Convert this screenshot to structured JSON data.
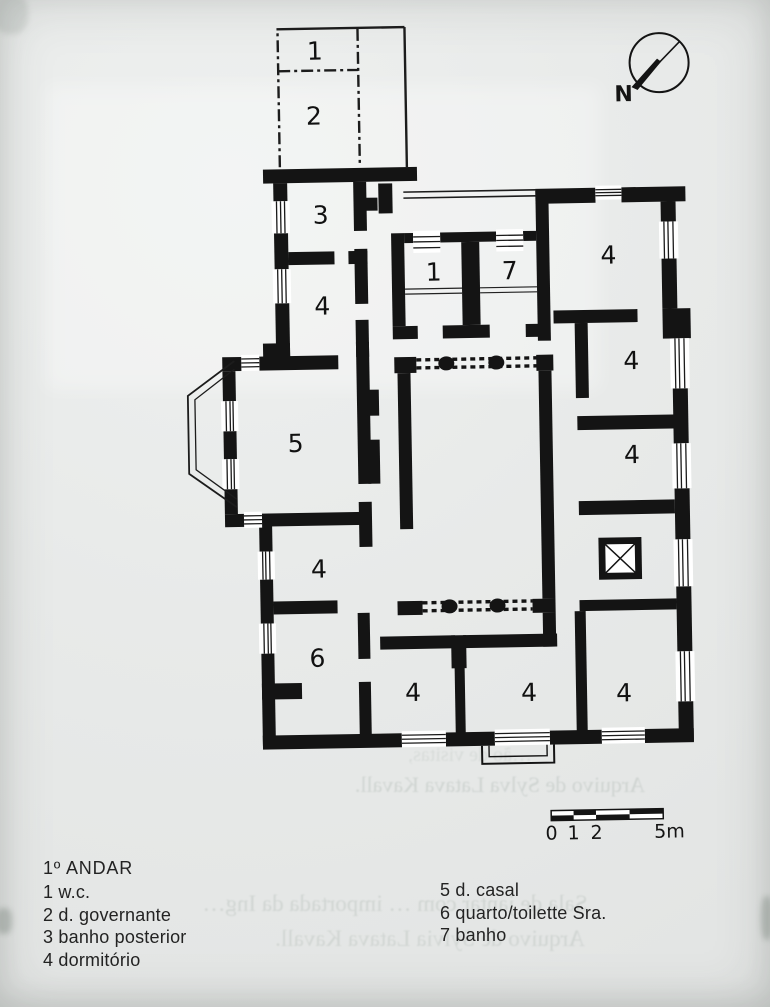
{
  "document_type": "floor-plan-scan",
  "colors": {
    "paper": "#e8eae9",
    "ink": "#141414"
  },
  "plan": {
    "rooms": [
      {
        "id": "annex-wc",
        "n": "1"
      },
      {
        "id": "annex-governante",
        "n": "2"
      },
      {
        "id": "banho-posterior",
        "n": "3"
      },
      {
        "id": "dormitorio-nw",
        "n": "4"
      },
      {
        "id": "wc-center",
        "n": "1"
      },
      {
        "id": "banho-center",
        "n": "7"
      },
      {
        "id": "dormitorio-ne",
        "n": "4"
      },
      {
        "id": "dormitorio-e1",
        "n": "4"
      },
      {
        "id": "dormitorio-e2",
        "n": "4"
      },
      {
        "id": "casal",
        "n": "5"
      },
      {
        "id": "dormitorio-w",
        "n": "4"
      },
      {
        "id": "quarto-toilette",
        "n": "6"
      },
      {
        "id": "dormitorio-s1",
        "n": "4"
      },
      {
        "id": "dormitorio-s2",
        "n": "4"
      },
      {
        "id": "dormitorio-s3",
        "n": "4"
      }
    ],
    "compass": {
      "label": "N"
    },
    "scale_bar": {
      "tick_labels": [
        "0",
        "1",
        "2"
      ],
      "end_label": "5m"
    }
  },
  "legend": {
    "title": "1º ANDAR",
    "left": [
      "1 w.c.",
      "2 d. governante",
      "3 banho posterior",
      "4 dormitório"
    ],
    "right": [
      "5 d. casal",
      "6 quarto/toilette Sra.",
      "7 banho"
    ]
  },
  "ghost_text": {
    "line1": "…ão de visitas,",
    "line2": "Arquivo de Sylva Latava Kavall.",
    "line3": "Sala de jantar com … importada da Ing…",
    "line4": "Arquivo de Sylvia Latava Kavall."
  }
}
